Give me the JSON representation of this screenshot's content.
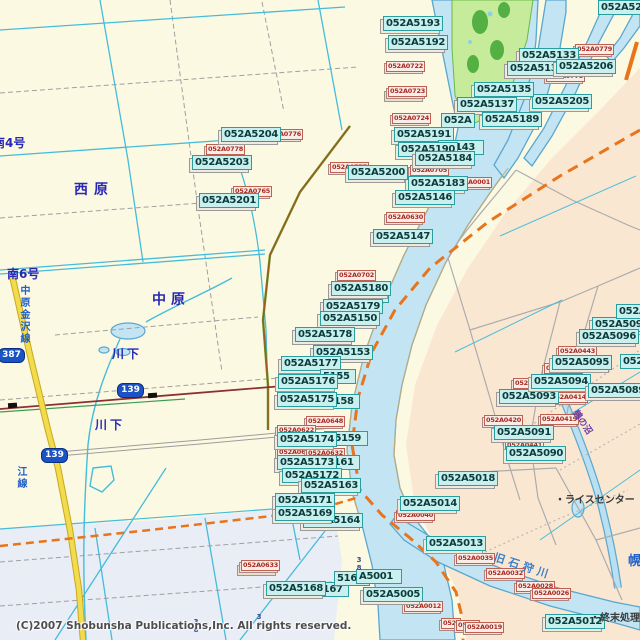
{
  "map": {
    "copyright": "(C)2007 Shobunsha Publications,Inc.  All rights reserved.",
    "colors": {
      "land_west": "#FCF9E3",
      "land_east": "#FAE7D2",
      "land_south": "#E9EDF6",
      "water_fill": "#C3E5F3",
      "water_edge": "#59A7CE",
      "park_fill": "#C6EB9B",
      "park_trees": "#54B043",
      "road_cyan": "#45BCDB",
      "road_gray": "#A4A4A4",
      "route_orange": "#E8741C",
      "rail_red": "#8B3030",
      "rail_green": "#3E9C52",
      "pref_road_yellow": "#F2DC4E",
      "code_box": "#C9F0EE",
      "code_border": "#2A9E9E",
      "code_text": "#0A3C3C",
      "red_box": "#FAEDE7",
      "red_text": "#A62A20",
      "shield_blue": "#1A53C4",
      "place_blue": "#2828B4"
    },
    "code_labels": [
      {
        "t": "052A5148",
        "x": 337,
        "y": 288,
        "w": 46,
        "p": 1
      },
      {
        "t": "052A5193",
        "x": 383,
        "y": 16
      },
      {
        "t": "052A5192",
        "x": 388,
        "y": 35
      },
      {
        "t": "052A520",
        "x": 598,
        "y": 0,
        "w": 42,
        "p": 1
      },
      {
        "t": "052A5133",
        "x": 519,
        "y": 48
      },
      {
        "t": "052A5134",
        "x": 507,
        "y": 61
      },
      {
        "t": "052A5206",
        "x": 556,
        "y": 59
      },
      {
        "t": "052A5205",
        "x": 532,
        "y": 94
      },
      {
        "t": "052A5135",
        "x": 474,
        "y": 82
      },
      {
        "t": "052A5137",
        "x": 457,
        "y": 97
      },
      {
        "t": "052A",
        "x": 441,
        "y": 113,
        "w": 28,
        "p": 1
      },
      {
        "t": "052A5189",
        "x": 482,
        "y": 112
      },
      {
        "t": "052A5191",
        "x": 394,
        "y": 127
      },
      {
        "t": "A5143",
        "x": 438,
        "y": 140,
        "w": 40,
        "p": 1
      },
      {
        "t": "052A5190",
        "x": 398,
        "y": 142
      },
      {
        "t": "052A5184",
        "x": 415,
        "y": 151
      },
      {
        "t": "052A5183",
        "x": 408,
        "y": 176
      },
      {
        "t": "052A0001",
        "x": 0,
        "y": 0,
        "w": 0,
        "hide": 1
      },
      {
        "t": "052A5146",
        "x": 395,
        "y": 190
      },
      {
        "t": "052A5147",
        "x": 373,
        "y": 229
      },
      {
        "t": "052A5204",
        "x": 221,
        "y": 127
      },
      {
        "t": "052A5203",
        "x": 192,
        "y": 155
      },
      {
        "t": "052A5201",
        "x": 199,
        "y": 193
      },
      {
        "t": "052A5200",
        "x": 348,
        "y": 165
      },
      {
        "t": "052A5180",
        "x": 331,
        "y": 281
      },
      {
        "t": "052A5179",
        "x": 323,
        "y": 299
      },
      {
        "t": "052A5150",
        "x": 320,
        "y": 311
      },
      {
        "t": "052A5178",
        "x": 295,
        "y": 327
      },
      {
        "t": "052A5153",
        "x": 313,
        "y": 345
      },
      {
        "t": "052A5177",
        "x": 281,
        "y": 356
      },
      {
        "t": "5155",
        "x": 320,
        "y": 369,
        "w": 30,
        "p": 1
      },
      {
        "t": "052A5176",
        "x": 278,
        "y": 374
      },
      {
        "t": "5158",
        "x": 324,
        "y": 394,
        "w": 30,
        "p": 1
      },
      {
        "t": "052A5175",
        "x": 277,
        "y": 392
      },
      {
        "t": "A5159",
        "x": 324,
        "y": 431,
        "w": 38,
        "p": 1
      },
      {
        "t": "052A5174",
        "x": 277,
        "y": 432
      },
      {
        "t": "5161",
        "x": 324,
        "y": 455,
        "w": 30,
        "p": 1
      },
      {
        "t": "052A5173",
        "x": 277,
        "y": 455
      },
      {
        "t": "052A5172",
        "x": 282,
        "y": 468
      },
      {
        "t": "052A5163",
        "x": 301,
        "y": 478
      },
      {
        "t": "052A5171",
        "x": 275,
        "y": 493
      },
      {
        "t": "052A5164",
        "x": 303,
        "y": 513
      },
      {
        "t": "052A5169",
        "x": 275,
        "y": 506
      },
      {
        "t": "5167",
        "x": 313,
        "y": 582,
        "w": 30,
        "p": 1
      },
      {
        "t": "052A5168",
        "x": 266,
        "y": 581
      },
      {
        "t": "5165",
        "x": 334,
        "y": 571,
        "w": 30,
        "p": 1
      },
      {
        "t": "A5001",
        "x": 356,
        "y": 569,
        "w": 40,
        "p": 1
      },
      {
        "t": "052A5005",
        "x": 363,
        "y": 587
      },
      {
        "t": "052A5018",
        "x": 438,
        "y": 471
      },
      {
        "t": "052A5014",
        "x": 400,
        "y": 496
      },
      {
        "t": "052A5013",
        "x": 426,
        "y": 536
      },
      {
        "t": "052A5012",
        "x": 545,
        "y": 614
      },
      {
        "t": "052A5091",
        "x": 494,
        "y": 425
      },
      {
        "t": "052A5090",
        "x": 506,
        "y": 446
      },
      {
        "t": "052A5093",
        "x": 499,
        "y": 389
      },
      {
        "t": "052A5094",
        "x": 531,
        "y": 374
      },
      {
        "t": "052A5089",
        "x": 588,
        "y": 383
      },
      {
        "t": "052A5095",
        "x": 552,
        "y": 355
      },
      {
        "t": "052A5097",
        "x": 592,
        "y": 317
      },
      {
        "t": "052A5096",
        "x": 579,
        "y": 329
      },
      {
        "t": "052A5",
        "x": 616,
        "y": 304,
        "w": 26,
        "p": 1
      },
      {
        "t": "052",
        "x": 620,
        "y": 354,
        "w": 22,
        "p": 1
      }
    ],
    "red_labels": [
      {
        "t": "052A0722",
        "x": 386,
        "y": 61
      },
      {
        "t": "052A0723",
        "x": 388,
        "y": 86,
        "s2": 1
      },
      {
        "t": "052A0724",
        "x": 392,
        "y": 113
      },
      {
        "t": "052A0776",
        "x": 264,
        "y": 129
      },
      {
        "t": "052A0778",
        "x": 206,
        "y": 144
      },
      {
        "t": "052A0765",
        "x": 233,
        "y": 186
      },
      {
        "t": "052A0777",
        "x": 330,
        "y": 162
      },
      {
        "t": "052A0779",
        "x": 575,
        "y": 44
      },
      {
        "t": "052A0778",
        "x": 546,
        "y": 71
      },
      {
        "t": "052A0001",
        "x": 453,
        "y": 177
      },
      {
        "t": "052A0705",
        "x": 410,
        "y": 165
      },
      {
        "t": "052A0630",
        "x": 386,
        "y": 212
      },
      {
        "t": "052A0702",
        "x": 337,
        "y": 270
      },
      {
        "t": "052A0648",
        "x": 306,
        "y": 416
      },
      {
        "t": "052A0622",
        "x": 277,
        "y": 425
      },
      {
        "t": "052A0629",
        "x": 277,
        "y": 447
      },
      {
        "t": "052A0632",
        "x": 306,
        "y": 448
      },
      {
        "t": "052A0633",
        "x": 241,
        "y": 560,
        "s2": 1
      },
      {
        "t": "052A0040",
        "x": 396,
        "y": 510
      },
      {
        "t": "052A0441",
        "x": 505,
        "y": 440
      },
      {
        "t": "052A0434",
        "x": 513,
        "y": 378
      },
      {
        "t": "052A0442",
        "x": 544,
        "y": 363
      },
      {
        "t": "052A0443",
        "x": 558,
        "y": 346
      },
      {
        "t": "052A0414",
        "x": 549,
        "y": 392
      },
      {
        "t": "052A0419",
        "x": 540,
        "y": 414
      },
      {
        "t": "052A0420",
        "x": 484,
        "y": 415
      },
      {
        "t": "052A0012",
        "x": 404,
        "y": 601
      },
      {
        "t": "052",
        "x": 441,
        "y": 618,
        "w": 16
      },
      {
        "t": "052A",
        "x": 456,
        "y": 620,
        "w": 20
      },
      {
        "t": "052A0019",
        "x": 465,
        "y": 622
      },
      {
        "t": "052A0035",
        "x": 456,
        "y": 553
      },
      {
        "t": "052A0032",
        "x": 486,
        "y": 568
      },
      {
        "t": "052A0028",
        "x": 516,
        "y": 581
      },
      {
        "t": "052A0026",
        "x": 532,
        "y": 588
      }
    ],
    "place_labels": [
      {
        "t": "南4号",
        "x": -7,
        "y": 134,
        "c": "blue",
        "f": 12
      },
      {
        "t": "西原",
        "x": 74,
        "y": 179,
        "c": "blue",
        "f": 14,
        "ls": 6
      },
      {
        "t": "南6号",
        "x": 7,
        "y": 265,
        "c": "blue",
        "f": 12
      },
      {
        "t": "中原",
        "x": 152,
        "y": 289,
        "c": "blue",
        "f": 14,
        "ls": 5
      },
      {
        "t": "川下",
        "x": 112,
        "y": 345,
        "c": "blue",
        "f": 12,
        "ls": 3
      },
      {
        "t": "川下",
        "x": 95,
        "y": 416,
        "c": "blue",
        "f": 12,
        "ls": 3
      },
      {
        "t": "幌",
        "x": 628,
        "y": 550,
        "c": "blue2",
        "f": 13
      },
      {
        "t": "中原金沢線",
        "x": 16,
        "y": 285,
        "c": "blue2",
        "f": 10,
        "vert": 1
      },
      {
        "t": "江線",
        "x": 13,
        "y": 466,
        "c": "blue2",
        "f": 10,
        "vert": 1
      },
      {
        "t": "旧石狩川",
        "x": 497,
        "y": 549,
        "c": "river",
        "f": 11,
        "rot": 18,
        "ls": 4
      },
      {
        "t": "鶴の沼",
        "x": 581,
        "y": 407,
        "c": "purple",
        "f": 9,
        "rot": 56
      }
    ],
    "poi_labels": [
      {
        "t": "・ライスセンター",
        "x": 555,
        "y": 491
      },
      {
        "t": "・終末処理場",
        "x": 590,
        "y": 609
      }
    ],
    "route_shields": [
      {
        "t": "387",
        "x": -2,
        "y": 348
      },
      {
        "t": "139",
        "x": 117,
        "y": 383
      },
      {
        "t": "139",
        "x": 41,
        "y": 448
      }
    ],
    "lot_numbers": [
      {
        "t": "38",
        "x": 355,
        "y": 556
      },
      {
        "t": "3",
        "x": 116,
        "y": 624
      },
      {
        "t": "38",
        "x": 192,
        "y": 618
      },
      {
        "t": "38",
        "x": 255,
        "y": 613
      }
    ]
  }
}
